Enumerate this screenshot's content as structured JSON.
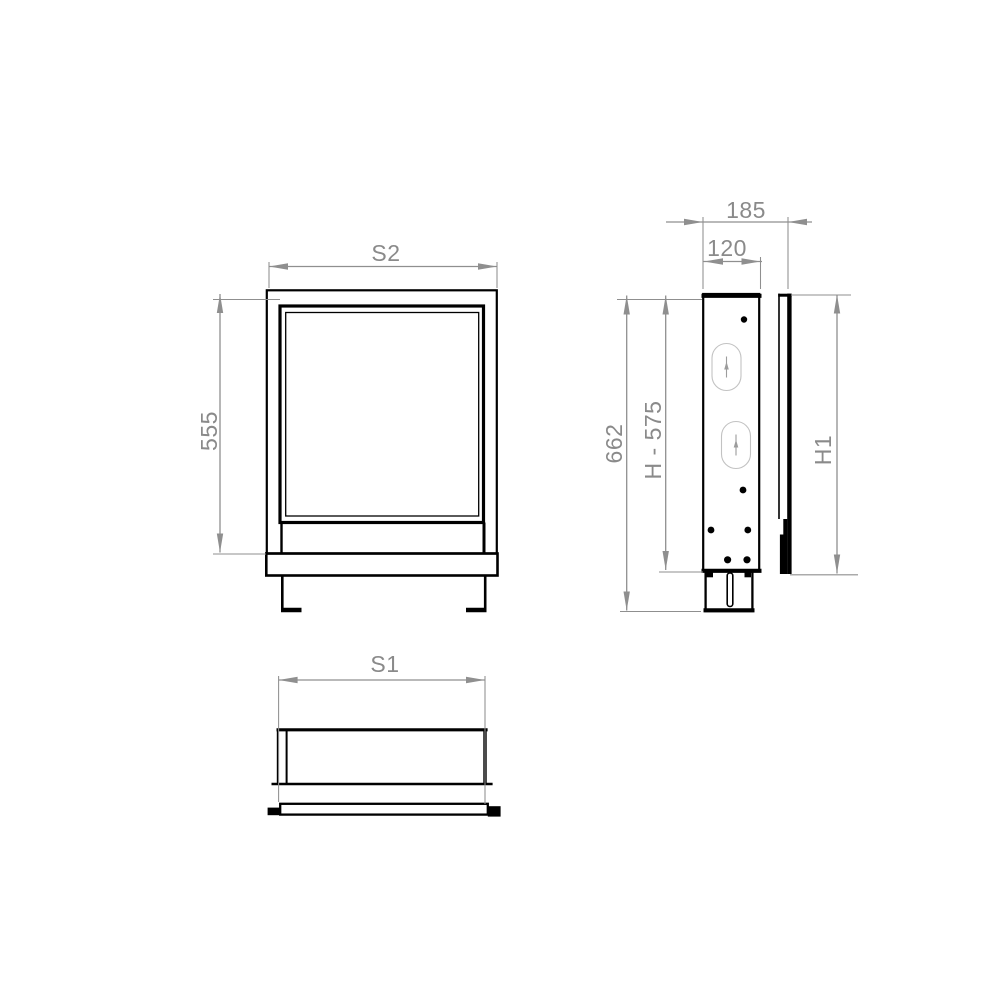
{
  "labels": {
    "front_width": "S2",
    "front_height": "555",
    "bottom_width": "S1",
    "side_depth_total": "185",
    "side_depth_body": "120",
    "side_height_total": "662",
    "side_height_body": "H - 575",
    "side_height_front": "H1"
  },
  "colors": {
    "drawing_line": "#000000",
    "dimension_line": "#8f8f8f",
    "dimension_text": "#8a8a8a",
    "detail_light": "#c2c2c2",
    "background": "#ffffff"
  }
}
